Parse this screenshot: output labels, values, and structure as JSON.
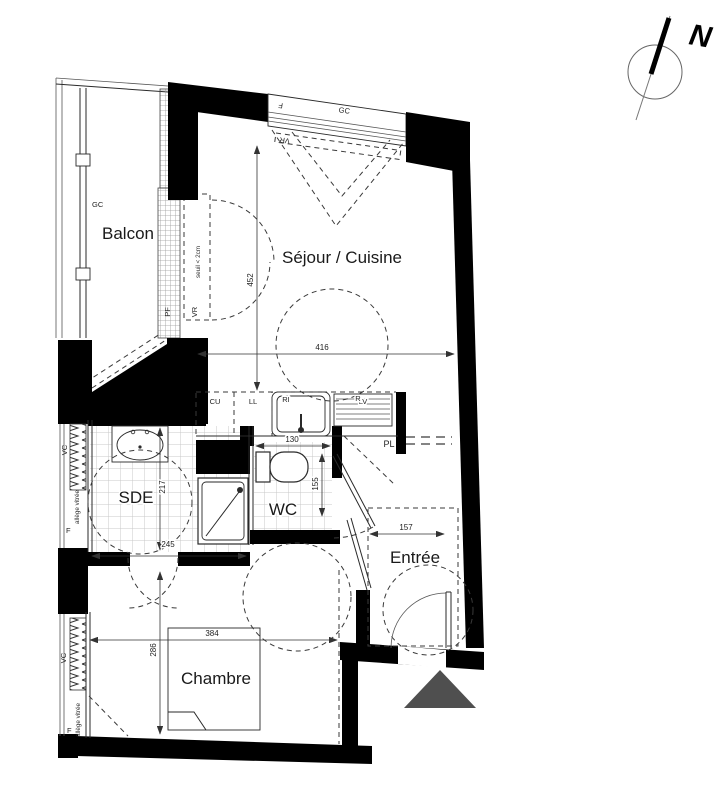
{
  "compass": {
    "north": "N"
  },
  "rooms": {
    "balcon": "Balcon",
    "sejour_cuisine": "Séjour / Cuisine",
    "sde": "SDE",
    "wc": "WC",
    "entree": "Entrée",
    "chambre": "Chambre"
  },
  "dimensions_cm": {
    "sejour_width": "416",
    "sejour_depth": "452",
    "sde_width": "245",
    "sde_depth": "217",
    "wc_width": "130",
    "wc_depth": "155",
    "entree_width": "157",
    "chambre_width": "384",
    "chambre_depth": "286"
  },
  "window_labels": {
    "gc_top": "GC",
    "f_top": "F",
    "vr_top": "VR",
    "gc_balcony": "GC",
    "pf_balcony": "PF",
    "vr_balcony": "VR",
    "seuil_note": "seuil < 2cm",
    "vc_sde": "VC",
    "allege_sde": "allège vitrée",
    "f_sde": "F",
    "vc_chambre": "VC",
    "allege_chambre": "allège vitrée",
    "f_chambre": "F"
  },
  "kitchen_labels": {
    "cu": "CU",
    "ll": "LL",
    "ri": "RI",
    "lv": "LV",
    "r": "R"
  },
  "closet_label": {
    "pl": "PL"
  },
  "colors": {
    "wall": "#000000",
    "line": "#2a2a2a",
    "dashed": "#3a3a3a",
    "tile": "#c9c9c9",
    "entrance_arrow": "#4f4f4f",
    "background": "#ffffff"
  }
}
